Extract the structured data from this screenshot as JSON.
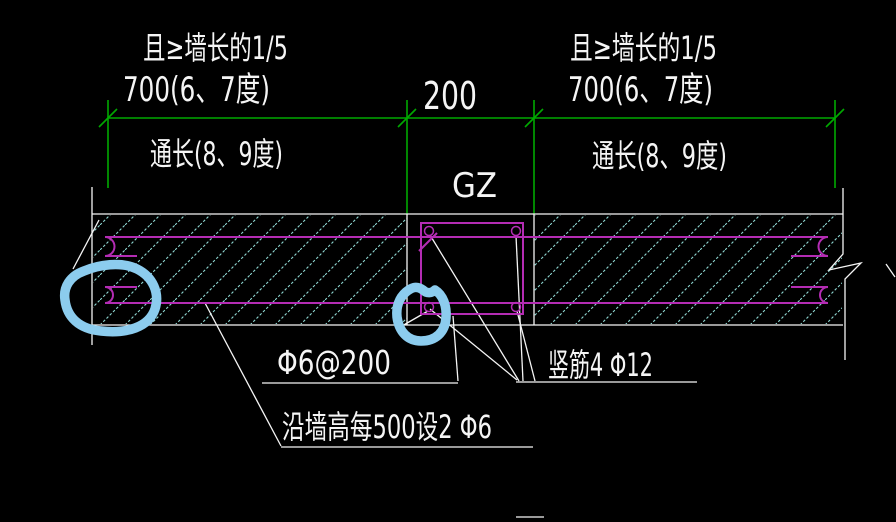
{
  "drawing": {
    "colors": {
      "background": "#000000",
      "line_white": "#f5f5f5",
      "dimension_green": "#00a900",
      "rebar_magenta": "#b42cb4",
      "hatch_cyan": "#8fd9d4",
      "highlight_blue": "#8cccee"
    },
    "dim_left": {
      "note": "且≥墙长的1/5",
      "value": "700(6、7度)",
      "span": "通长(8、9度)"
    },
    "dim_middle": {
      "value": "200"
    },
    "dim_right": {
      "note": "且≥墙长的1/5",
      "value": "700(6、7度)",
      "span": "通长(8、9度)"
    },
    "column": {
      "label": "GZ"
    },
    "labels": {
      "stirrup": "Φ6@200",
      "vertical_bars": "竖筋4 Φ12",
      "wall_bars": "沿墙高每500设2 Φ6"
    }
  }
}
